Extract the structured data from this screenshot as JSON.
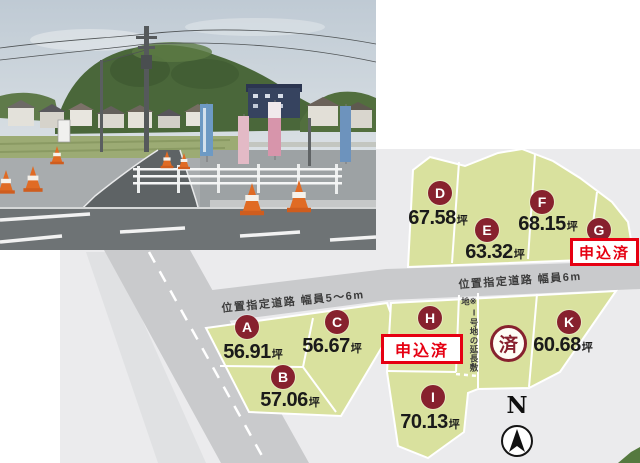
{
  "site_plan": {
    "road_labels": [
      "位置指定道路 幅員5〜6m",
      "位置指定道路 幅員6m"
    ],
    "unit": "坪",
    "plots": [
      {
        "id": "A",
        "area": "56.91"
      },
      {
        "id": "B",
        "area": "57.06"
      },
      {
        "id": "C",
        "area": "56.67"
      },
      {
        "id": "D",
        "area": "67.58"
      },
      {
        "id": "E",
        "area": "63.32"
      },
      {
        "id": "F",
        "area": "68.15"
      },
      {
        "id": "G",
        "status": "申込済"
      },
      {
        "id": "H",
        "status": "申込済"
      },
      {
        "id": "I",
        "area": "70.13"
      },
      {
        "id": "K",
        "area": "60.68"
      }
    ],
    "sold_mark": "済",
    "flag_note": "※I号地の延長敷地",
    "compass_label": "N",
    "colors": {
      "map_bg": "#ebebed",
      "road_gray": "#c9cacc",
      "plot_green": "#d9e19e",
      "pin_maroon": "#87212e",
      "badge_red": "#e60012"
    }
  }
}
